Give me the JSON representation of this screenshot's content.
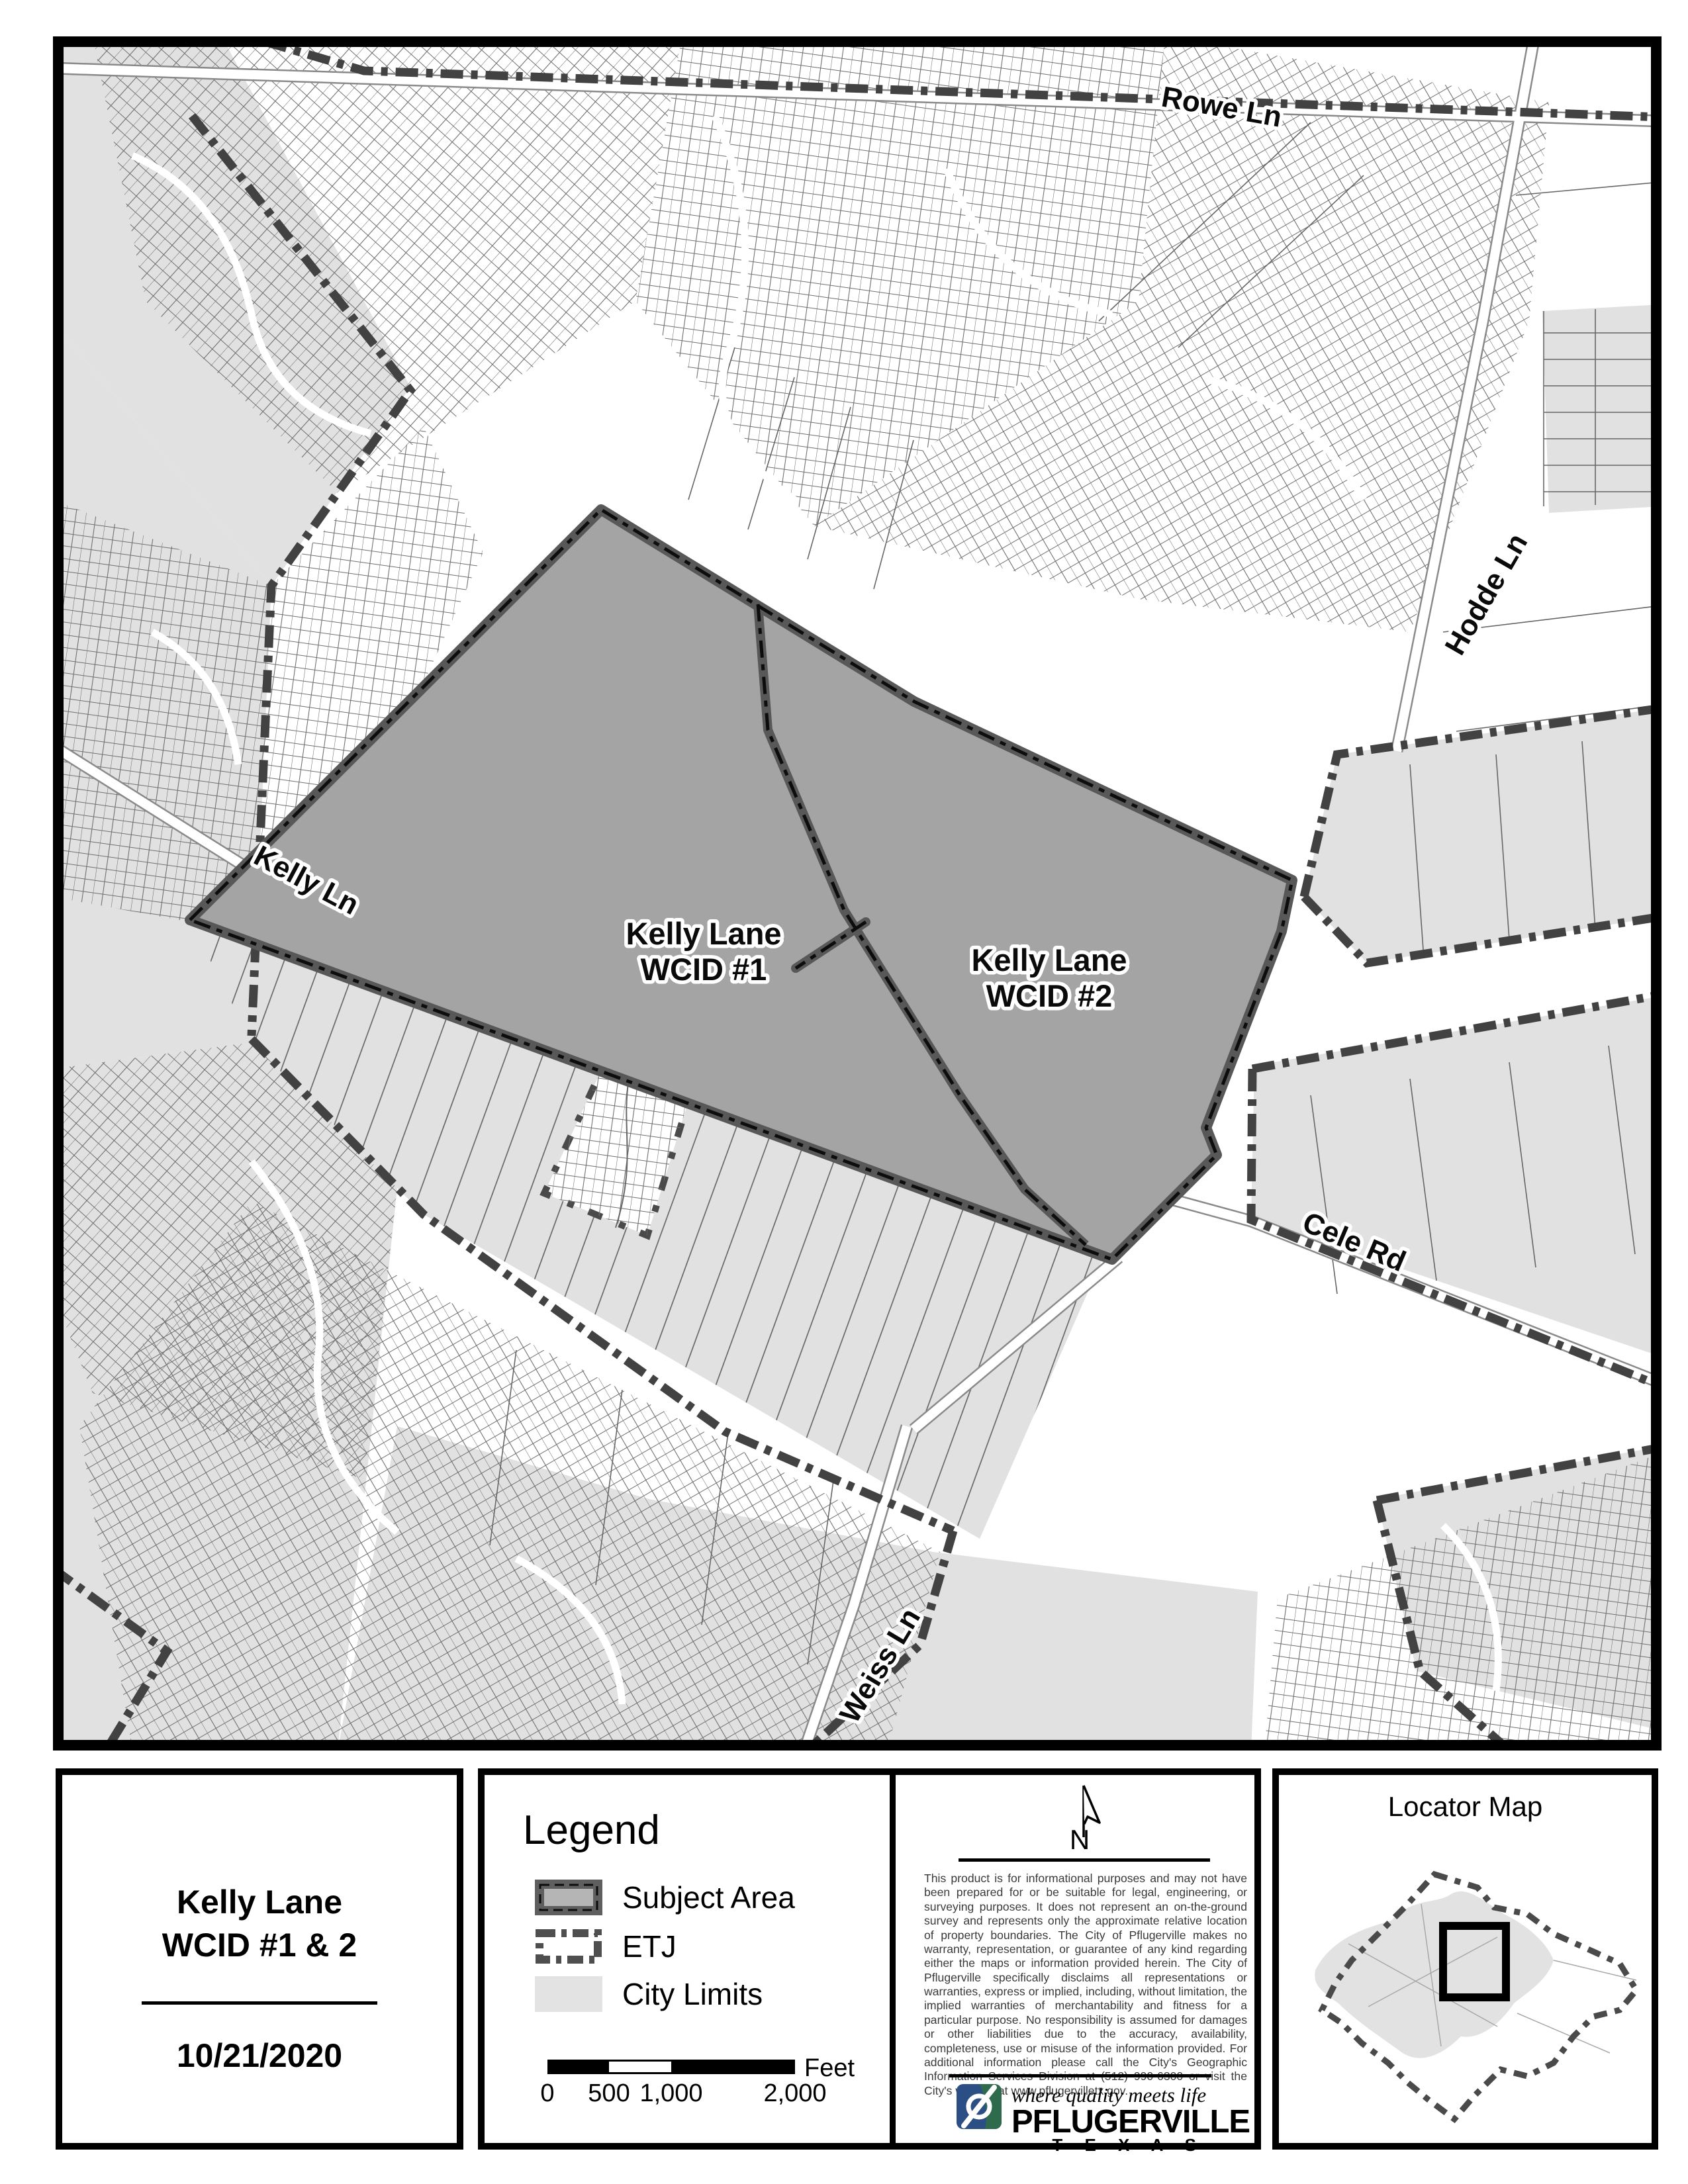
{
  "map": {
    "road_labels": [
      "Rowe Ln",
      "Hodde Ln",
      "Kelly Ln",
      "Cele Rd",
      "Weiss Ln"
    ],
    "area_labels": [
      {
        "line1": "Kelly Lane",
        "line2": "WCID #1"
      },
      {
        "line1": "Kelly Lane",
        "line2": "WCID #2"
      }
    ]
  },
  "title_block": {
    "title_line1": "Kelly Lane",
    "title_line2": "WCID #1 & 2",
    "date": "10/21/2020"
  },
  "legend": {
    "title": "Legend",
    "items": [
      {
        "label": "Subject Area"
      },
      {
        "label": "ETJ"
      },
      {
        "label": "City Limits"
      }
    ]
  },
  "scale_bar": {
    "ticks": [
      "0",
      "500",
      "1,000",
      "2,000"
    ],
    "unit": "Feet"
  },
  "north_arrow": {
    "label": "N"
  },
  "disclaimer": "This product is for informational purposes and may not have been prepared for or be suitable for legal, engineering, or surveying purposes. It does not represent an on-the-ground survey and represents only the approximate relative location of property boundaries. The City of Pflugerville makes no warranty, representation, or guarantee of any kind regarding either the maps or information provided herein. The City of Pflugerville specifically disclaims all representations or warranties, express or implied, including, without limitation, the implied warranties of merchantability and fitness for a particular purpose. No responsibility is assumed for damages or other liabilities due to the accuracy, availability, completeness, use or misuse of the information provided. For additional information please call the City's Geographic Information Services Division at (512) 990-6300 or visit the City's website at www.pflugervilletx.gov.",
  "logo": {
    "tagline": "where quality meets life",
    "name": "PFLUGERVILLE",
    "state": "T E X A S"
  },
  "locator": {
    "title": "Locator Map"
  },
  "colors": {
    "subject_fill": "#a4a4a4",
    "subject_border": "#585858",
    "city_limits": "#e1e1e1",
    "etj": "#424242",
    "parcel_line": "#6f6f6f",
    "logo_blue": "#2b4f85",
    "logo_green": "#2e6b4c"
  }
}
